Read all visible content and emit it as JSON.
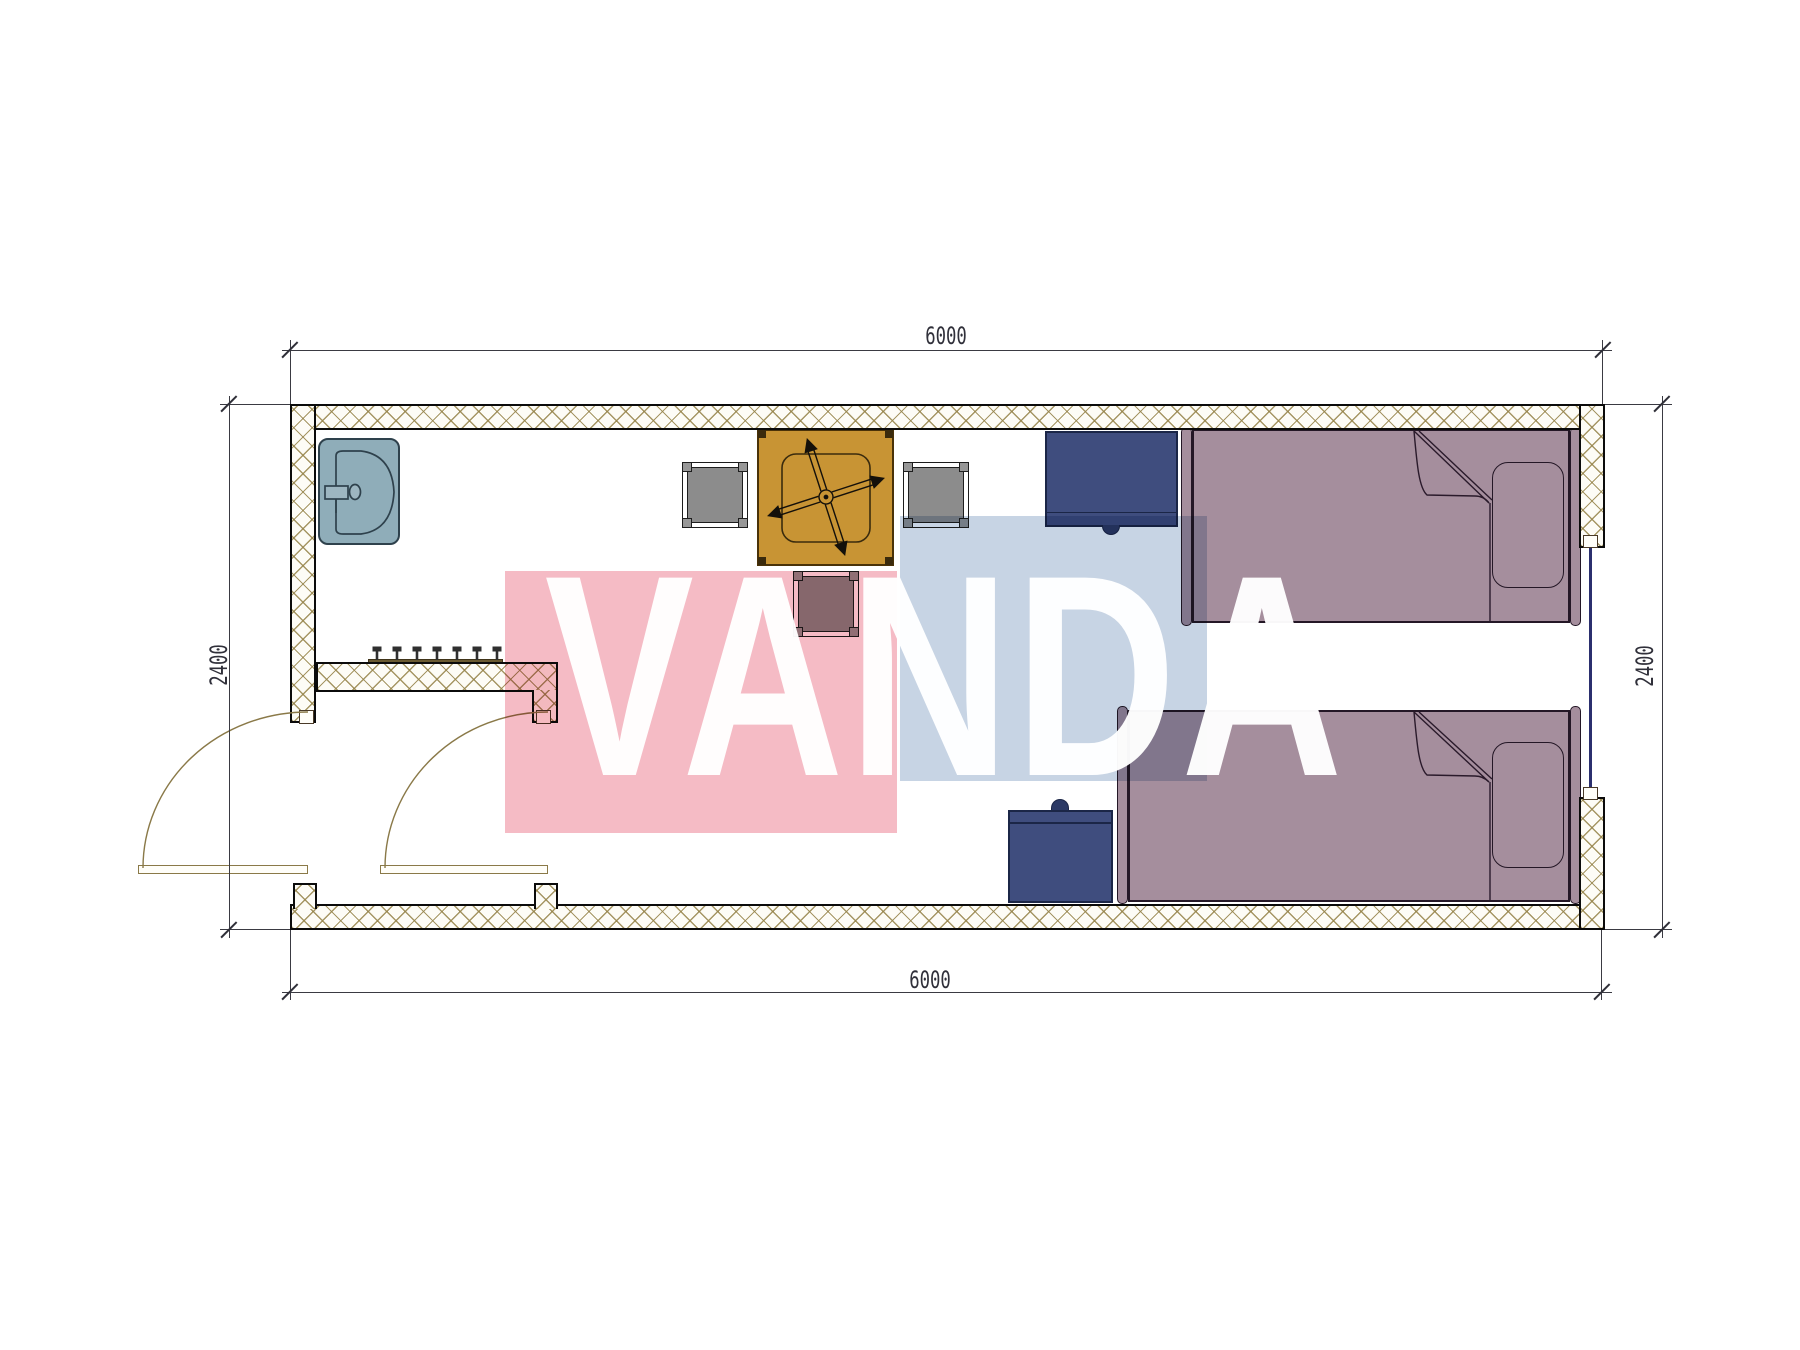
{
  "title": "container-room-floor-plan",
  "dimensions": {
    "top": "6000",
    "bottom": "6000",
    "left": "2400",
    "right": "2400"
  },
  "watermark": {
    "text": "VANDA",
    "pink_color": "#f5bbc5",
    "blue_color": "#c7d4e4",
    "text_color": "#ffffff"
  },
  "palette": {
    "wall_hatch": "#96844a",
    "wall_outline": "#0b0b0b",
    "sink": "#8fadb9",
    "table": "#c89434",
    "stool": "#8c8c8c",
    "nightstand": "#3f4d7e",
    "bed": "#a58e9d",
    "door": "#8a7948",
    "window_glass": "#2b2f6e",
    "dimension": "#3a3a42"
  },
  "furniture": [
    {
      "name": "sink"
    },
    {
      "name": "coat-rack",
      "hooks": 7
    },
    {
      "name": "table-with-ceiling-fan"
    },
    {
      "name": "stool",
      "count": 3
    },
    {
      "name": "nightstand",
      "count": 2
    },
    {
      "name": "single-bed",
      "count": 2
    }
  ]
}
